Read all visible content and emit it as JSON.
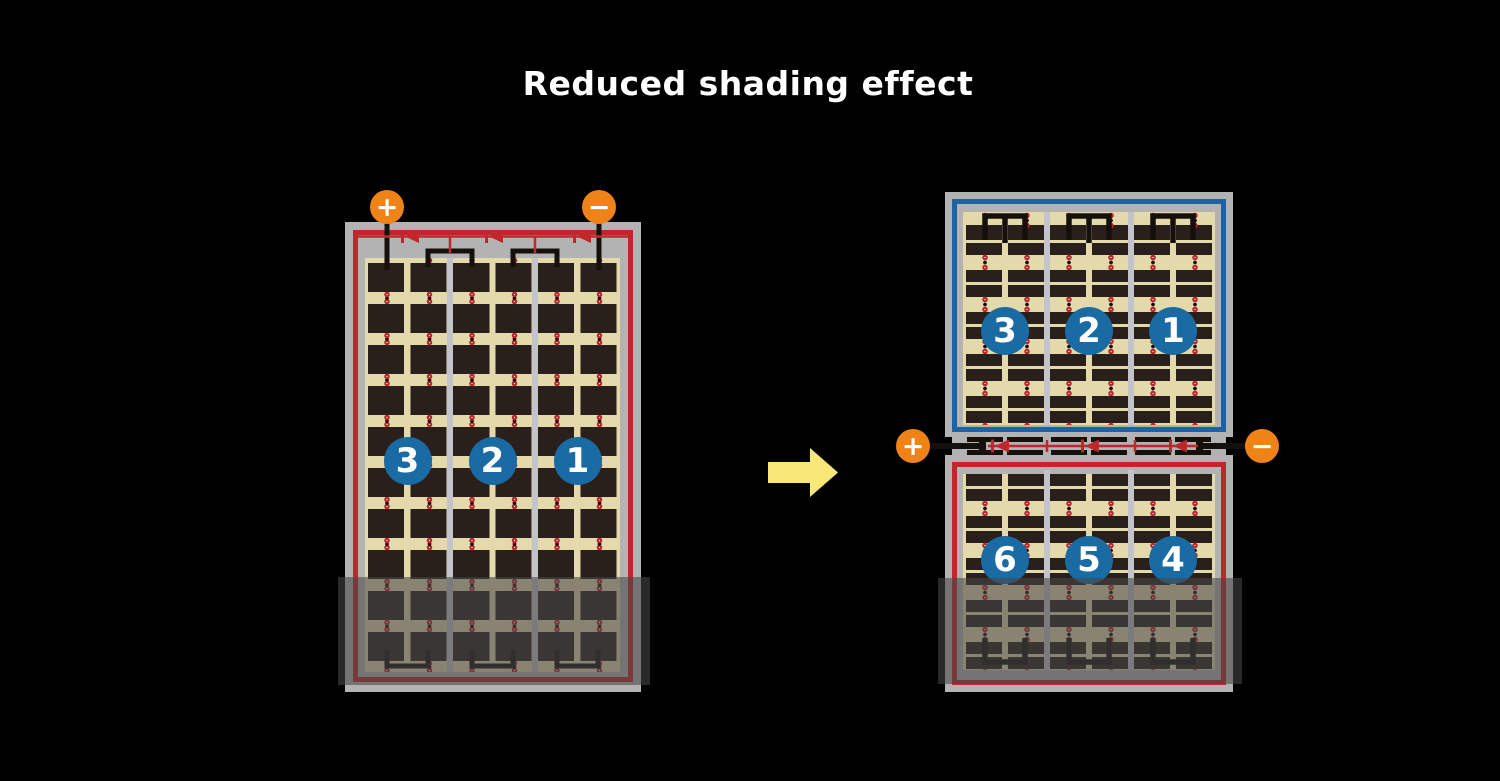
{
  "title": "Reduced shading effect",
  "colors": {
    "background": "#000000",
    "panel_frame_gray": "#b3b3b3",
    "cell_background_cream": "#e3d9ab",
    "cell_dark": "#2a201b",
    "series_loop_red": "#bf272c",
    "half_cut_loop_blue": "#1c63a5",
    "terminal_orange": "#ef8318",
    "string_badge_blue": "#1a6ba4",
    "arrow_yellow": "#f9e878"
  },
  "before_panel": {
    "terminals": [
      {
        "symbol": "+"
      },
      {
        "symbol": "−"
      }
    ],
    "cell_strings": [
      {
        "number": "3"
      },
      {
        "number": "2"
      },
      {
        "number": "1"
      }
    ],
    "bypass_diode_count": 3
  },
  "after_panel": {
    "terminals": [
      {
        "symbol": "+"
      },
      {
        "symbol": "−"
      }
    ],
    "top_half_strings": [
      {
        "number": "3"
      },
      {
        "number": "2"
      },
      {
        "number": "1"
      }
    ],
    "bottom_half_strings": [
      {
        "number": "6"
      },
      {
        "number": "5"
      },
      {
        "number": "4"
      }
    ],
    "bypass_diode_count": 3
  }
}
